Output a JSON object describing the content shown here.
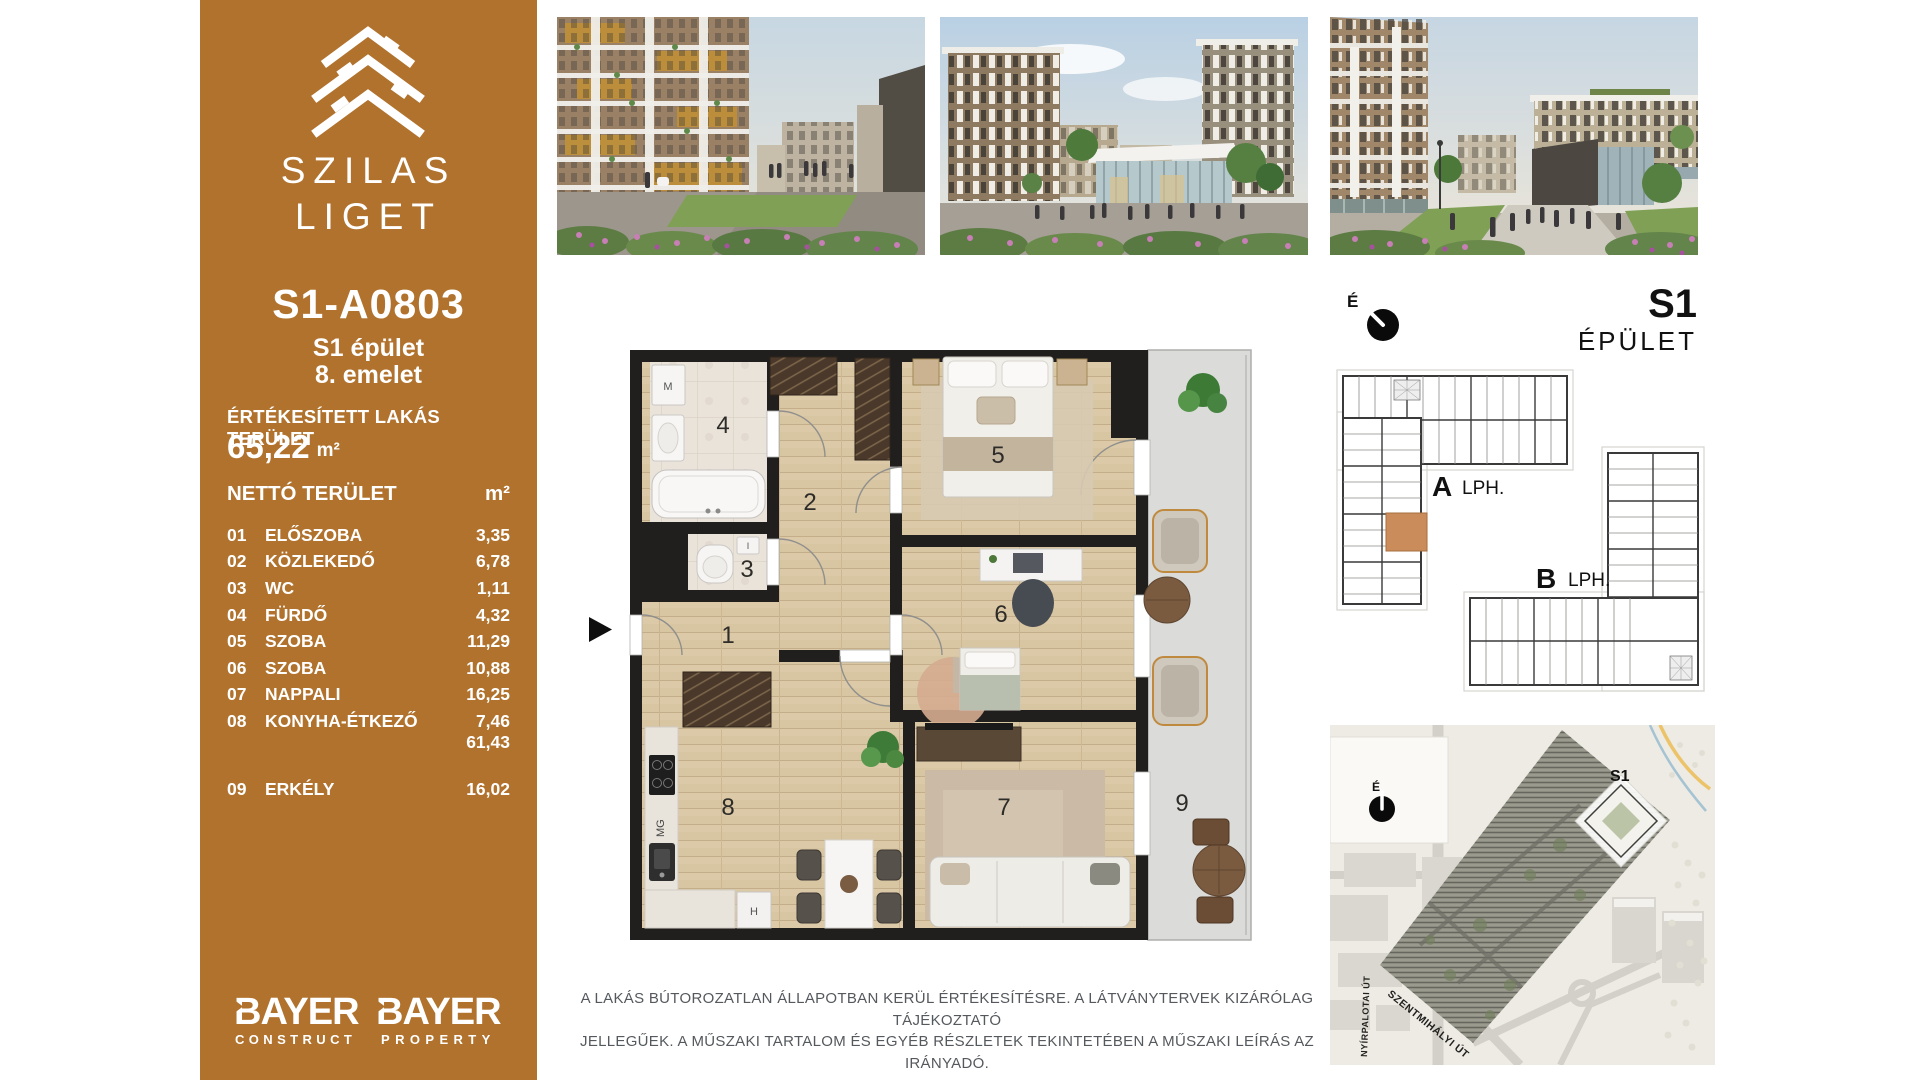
{
  "sidebar": {
    "brand": {
      "line1": "SZILAS",
      "line2": "LIGET"
    },
    "unit": {
      "code": "S1-A0803",
      "building": "S1 épület",
      "floor": "8. emelet"
    },
    "sold_area": {
      "label": "ÉRTÉKESÍTETT LAKÁS TERÜLET",
      "value": "65,22",
      "unit": "m²"
    },
    "net": {
      "label": "NETTÓ TERÜLET",
      "unit": "m²",
      "total": "61,43"
    },
    "rooms": [
      {
        "no": "01",
        "name": "ELŐSZOBA",
        "area": "3,35"
      },
      {
        "no": "02",
        "name": "KÖZLEKEDŐ",
        "area": "6,78"
      },
      {
        "no": "03",
        "name": "WC",
        "area": "1,11"
      },
      {
        "no": "04",
        "name": "FÜRDŐ",
        "area": "4,32"
      },
      {
        "no": "05",
        "name": "SZOBA",
        "area": "11,29"
      },
      {
        "no": "06",
        "name": "SZOBA",
        "area": "10,88"
      },
      {
        "no": "07",
        "name": "NAPPALI",
        "area": "16,25"
      },
      {
        "no": "08",
        "name": "KONYHA-ÉTKEZŐ",
        "area": "7,46"
      }
    ],
    "balcony": {
      "no": "09",
      "name": "ERKÉLY",
      "area": "16,02"
    },
    "brands": [
      {
        "name": "BAYER",
        "sub": "CONSTRUCT"
      },
      {
        "name": "BAYER",
        "sub": "PROPERTY"
      }
    ]
  },
  "floorplan": {
    "numbers": [
      "1",
      "2",
      "3",
      "4",
      "5",
      "6",
      "7",
      "8",
      "9"
    ],
    "labels": {
      "washer": "M",
      "cistern": "I",
      "dishwasher": "MG",
      "fridge": "H"
    }
  },
  "building_panel": {
    "north": "É",
    "code": "S1",
    "label": "ÉPÜLET",
    "wing_a": "A",
    "wing_a_sub": "LPH.",
    "wing_b": "B",
    "wing_b_sub": "LPH."
  },
  "site_map": {
    "north": "É",
    "tag": "S1",
    "street_left": "NYÍRPALOTAI ÚT",
    "street_bottom": "SZENTMIHÁLYI ÚT"
  },
  "disclaimer": {
    "line1": "A LAKÁS BÚTOROZATLAN ÁLLAPOTBAN KERÜL ÉRTÉKESÍTÉSRE. A LÁTVÁNYTERVEK KIZÁRÓLAG TÁJÉKOZTATÓ",
    "line2": "JELLEGŰEK. A MŰSZAKI TARTALOM ÉS EGYÉB RÉSZLETEK TEKINTETÉBEN A MŰSZAKI LEÍRÁS AZ IRÁNYADÓ."
  },
  "colors": {
    "sidebar": "#B0722D",
    "accent_unit": "#CB8C5B",
    "wall": "#211F1D",
    "wood": "#D8C5A2",
    "balcony": "#DBDBD9",
    "disclaimer": "#55595D"
  }
}
